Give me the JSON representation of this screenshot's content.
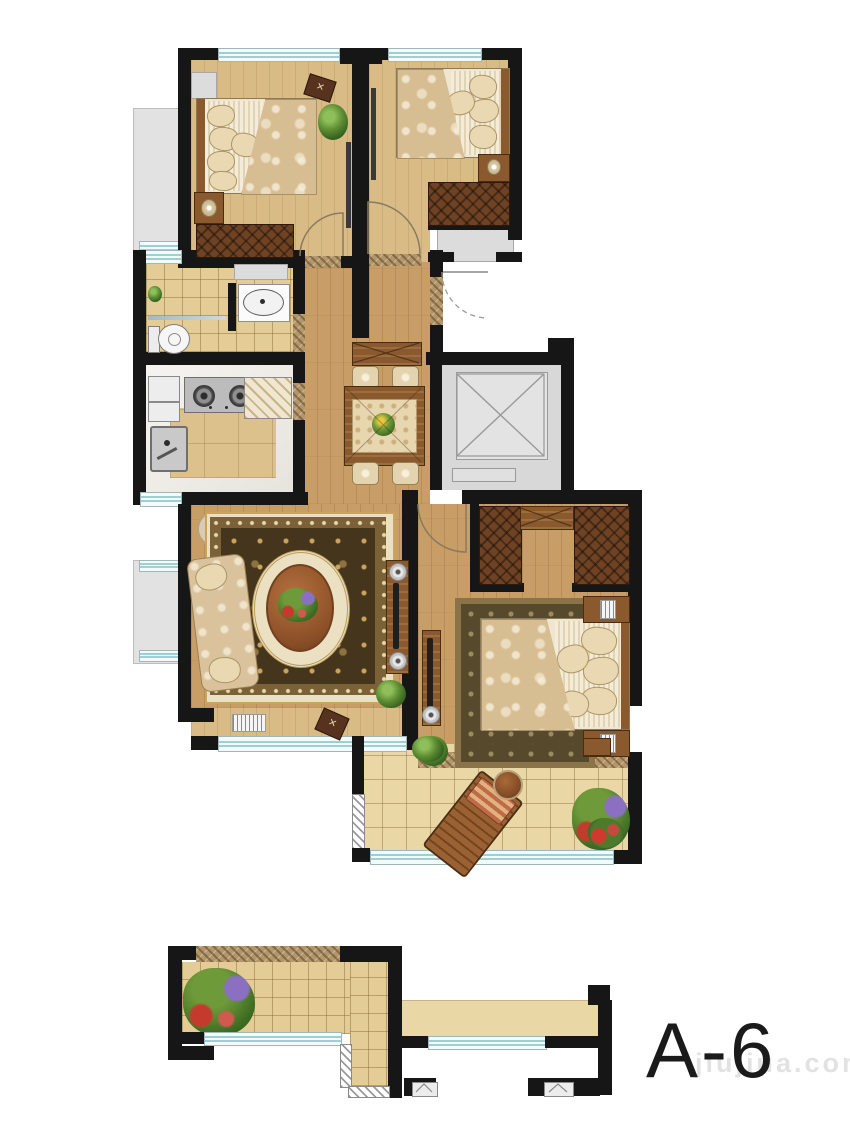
{
  "labels": {
    "unit": "A-6",
    "watermark": "jiujiua.com"
  },
  "colors": {
    "wall": "#161616",
    "window_line": "#9ecfd2",
    "window_bg": "#f4fafa",
    "wood": "#c89e66",
    "wood_light": "#d9bb85",
    "tile": "#e4cc96",
    "balcony_tile": "#e9d7a6",
    "marble_center": "#dcc18d",
    "outside": "#e2e2e2",
    "elevator": "#d8d8d8",
    "wardrobe": "#6e4223",
    "furniture_wood": "#8a5a2e",
    "stone": "#b3976a",
    "rug_gold": "#c9a45c",
    "rug_field": "#46351d",
    "rug_cream": "#ece0c2",
    "sofa": "#d9c29c",
    "text": "#1a1a1a",
    "watermark": "#d9d9d9"
  }
}
